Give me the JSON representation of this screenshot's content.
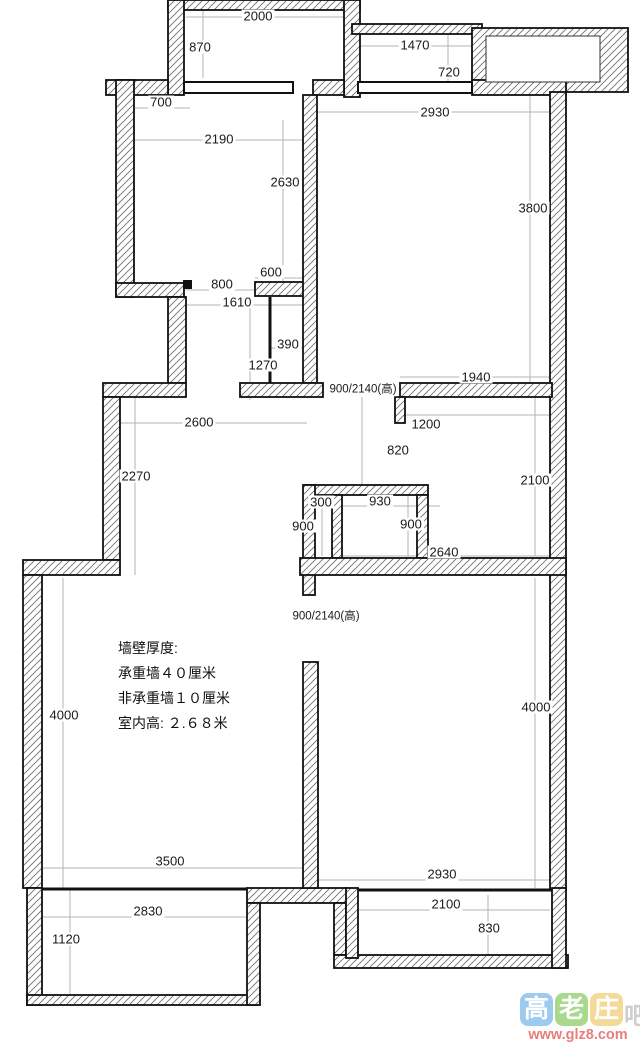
{
  "title": "apartment floor plan with dimensions",
  "colors": {
    "wall_outline": "#111111",
    "hatch_stroke": "#666666",
    "dimension_line": "#b3b3b3",
    "label_text": "#1a1a1a",
    "watermark_url_color": "#e57070"
  },
  "dimension_labels": [
    {
      "text": "2000",
      "x": 258,
      "y": 16
    },
    {
      "text": "870",
      "x": 200,
      "y": 47
    },
    {
      "text": "1470",
      "x": 415,
      "y": 45
    },
    {
      "text": "720",
      "x": 449,
      "y": 72
    },
    {
      "text": "700",
      "x": 161,
      "y": 102
    },
    {
      "text": "2190",
      "x": 219,
      "y": 139
    },
    {
      "text": "2930",
      "x": 435,
      "y": 112
    },
    {
      "text": "2630",
      "x": 285,
      "y": 182
    },
    {
      "text": "3800",
      "x": 533,
      "y": 208
    },
    {
      "text": "600",
      "x": 271,
      "y": 272
    },
    {
      "text": "800",
      "x": 222,
      "y": 284
    },
    {
      "text": "1610",
      "x": 237,
      "y": 302
    },
    {
      "text": "390",
      "x": 288,
      "y": 344
    },
    {
      "text": "1270",
      "x": 263,
      "y": 365
    },
    {
      "text": "1940",
      "x": 476,
      "y": 377
    },
    {
      "text": "1200",
      "x": 426,
      "y": 424
    },
    {
      "text": "820",
      "x": 398,
      "y": 450
    },
    {
      "text": "2600",
      "x": 199,
      "y": 422
    },
    {
      "text": "2270",
      "x": 136,
      "y": 476
    },
    {
      "text": "2100",
      "x": 535,
      "y": 480
    },
    {
      "text": "300",
      "x": 321,
      "y": 502
    },
    {
      "text": "930",
      "x": 380,
      "y": 501
    },
    {
      "text": "900",
      "x": 303,
      "y": 526
    },
    {
      "text": "900",
      "x": 411,
      "y": 524
    },
    {
      "text": "2640",
      "x": 444,
      "y": 552
    },
    {
      "text": "4000",
      "x": 64,
      "y": 715
    },
    {
      "text": "4000",
      "x": 536,
      "y": 707
    },
    {
      "text": "3500",
      "x": 170,
      "y": 861
    },
    {
      "text": "2930",
      "x": 442,
      "y": 874
    },
    {
      "text": "2830",
      "x": 148,
      "y": 911
    },
    {
      "text": "1120",
      "x": 66,
      "y": 939
    },
    {
      "text": "2100",
      "x": 446,
      "y": 904
    },
    {
      "text": "830",
      "x": 489,
      "y": 928
    }
  ],
  "door_labels": [
    {
      "text": "900/2140(高)",
      "x": 363,
      "y": 390
    },
    {
      "text": "900/2140(高)",
      "x": 326,
      "y": 617
    }
  ],
  "annotation": {
    "x": 118,
    "line_ys": [
      648,
      673,
      698,
      723
    ],
    "lines": [
      "墙壁厚度:",
      "承重墙４０厘米",
      "非承重墙１０厘米",
      "室内高: ２.６８米"
    ]
  },
  "watermark": {
    "tiles": [
      {
        "char": "高",
        "bg": "#8cc3ee",
        "left": 4
      },
      {
        "char": "老",
        "bg": "#9ad378",
        "left": 39
      },
      {
        "char": "庄",
        "bg": "#f2d488",
        "left": 74
      }
    ],
    "trailing_char": "吧",
    "url": "www.glz8.com"
  }
}
